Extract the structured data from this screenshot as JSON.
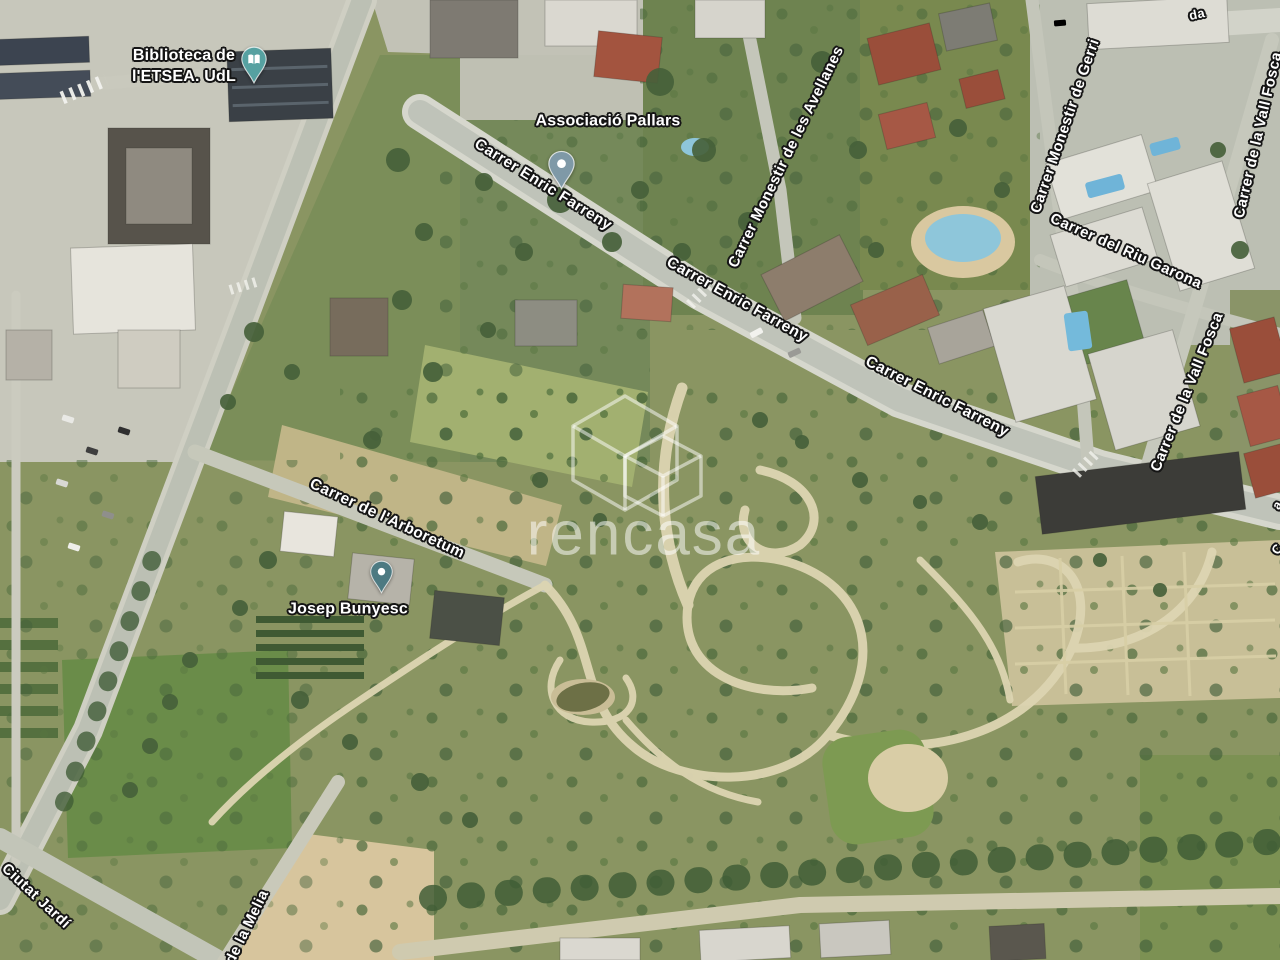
{
  "watermark": {
    "text": "rencasa"
  },
  "poi_labels": [
    {
      "name": "biblioteca-de-letsea-udl",
      "lines": [
        "Biblioteca de",
        "l'ETSEA. UdL"
      ],
      "text_x": 184,
      "text_y": 66,
      "pin": "book",
      "pin_color_key": "pin_biblioteca",
      "pin_x": 254,
      "pin_y": 84,
      "pin_w": 26,
      "pin_h": 38
    },
    {
      "name": "associacio-pallars",
      "lines": [
        "Associació Pallars"
      ],
      "text_x": 608,
      "text_y": 121,
      "pin": "dot",
      "pin_color_key": "pin_pallars",
      "pin_x": 561,
      "pin_y": 192,
      "pin_w": 27,
      "pin_h": 44
    },
    {
      "name": "josep-bunyesc",
      "lines": [
        "Josep Bunyesc"
      ],
      "text_x": 348,
      "text_y": 609,
      "pin": "dot",
      "pin_color_key": "pin_bunyesc",
      "pin_x": 381,
      "pin_y": 594,
      "pin_w": 23,
      "pin_h": 34
    }
  ],
  "street_labels": [
    {
      "text": "Carrer Enric Farreny",
      "x": 543,
      "y": 185,
      "rot": 32,
      "size": 15.5
    },
    {
      "text": "Carrer Enric Farreny",
      "x": 737,
      "y": 300,
      "rot": 29,
      "size": 15.5
    },
    {
      "text": "Carrer Enric Farreny",
      "x": 937,
      "y": 397,
      "rot": 27,
      "size": 15.5
    },
    {
      "text": "Carrer Monestir de les Avellanes",
      "x": 786,
      "y": 157,
      "rot": -64,
      "size": 15
    },
    {
      "text": "Carrer Monestir de Gerri",
      "x": 1065,
      "y": 126,
      "rot": -71,
      "size": 15
    },
    {
      "text": "Carrer del Riu Garona",
      "x": 1126,
      "y": 251,
      "rot": 24,
      "size": 15
    },
    {
      "text": "Carrer de la Vall Fosca",
      "x": 1258,
      "y": 135,
      "rot": -77,
      "size": 15
    },
    {
      "text": "Carrer de la Vall Fosca",
      "x": 1187,
      "y": 392,
      "rot": -68,
      "size": 15
    },
    {
      "text": "Carrer de l'Arboretum",
      "x": 387,
      "y": 519,
      "rot": 25,
      "size": 15.5
    },
    {
      "text": "Ciutat Jardí",
      "x": 36,
      "y": 896,
      "rot": 43,
      "size": 15
    },
    {
      "text": "de la Melia",
      "x": 247,
      "y": 927,
      "rot": -64,
      "size": 15
    },
    {
      "text": "da",
      "x": 1197,
      "y": 14,
      "rot": -12,
      "size": 13,
      "fragment": true
    },
    {
      "text": "a",
      "x": 1277,
      "y": 505,
      "rot": -60,
      "size": 13,
      "fragment": true
    },
    {
      "text": "C",
      "x": 1277,
      "y": 549,
      "rot": -60,
      "size": 13,
      "fragment": true
    }
  ],
  "colors": {
    "pin_biblioteca": "#56a1a1",
    "pin_pallars": "#7f99a7",
    "pin_bunyesc": "#4d7a82",
    "label_text": "#ffffff",
    "label_outline": "#151515",
    "watermark_white": "#ffffff",
    "pool_blue": "#7fbcd9",
    "red_roof": "#9a4e3a",
    "road_grey": "#c0c4ba",
    "park_green": "#7f9155"
  }
}
